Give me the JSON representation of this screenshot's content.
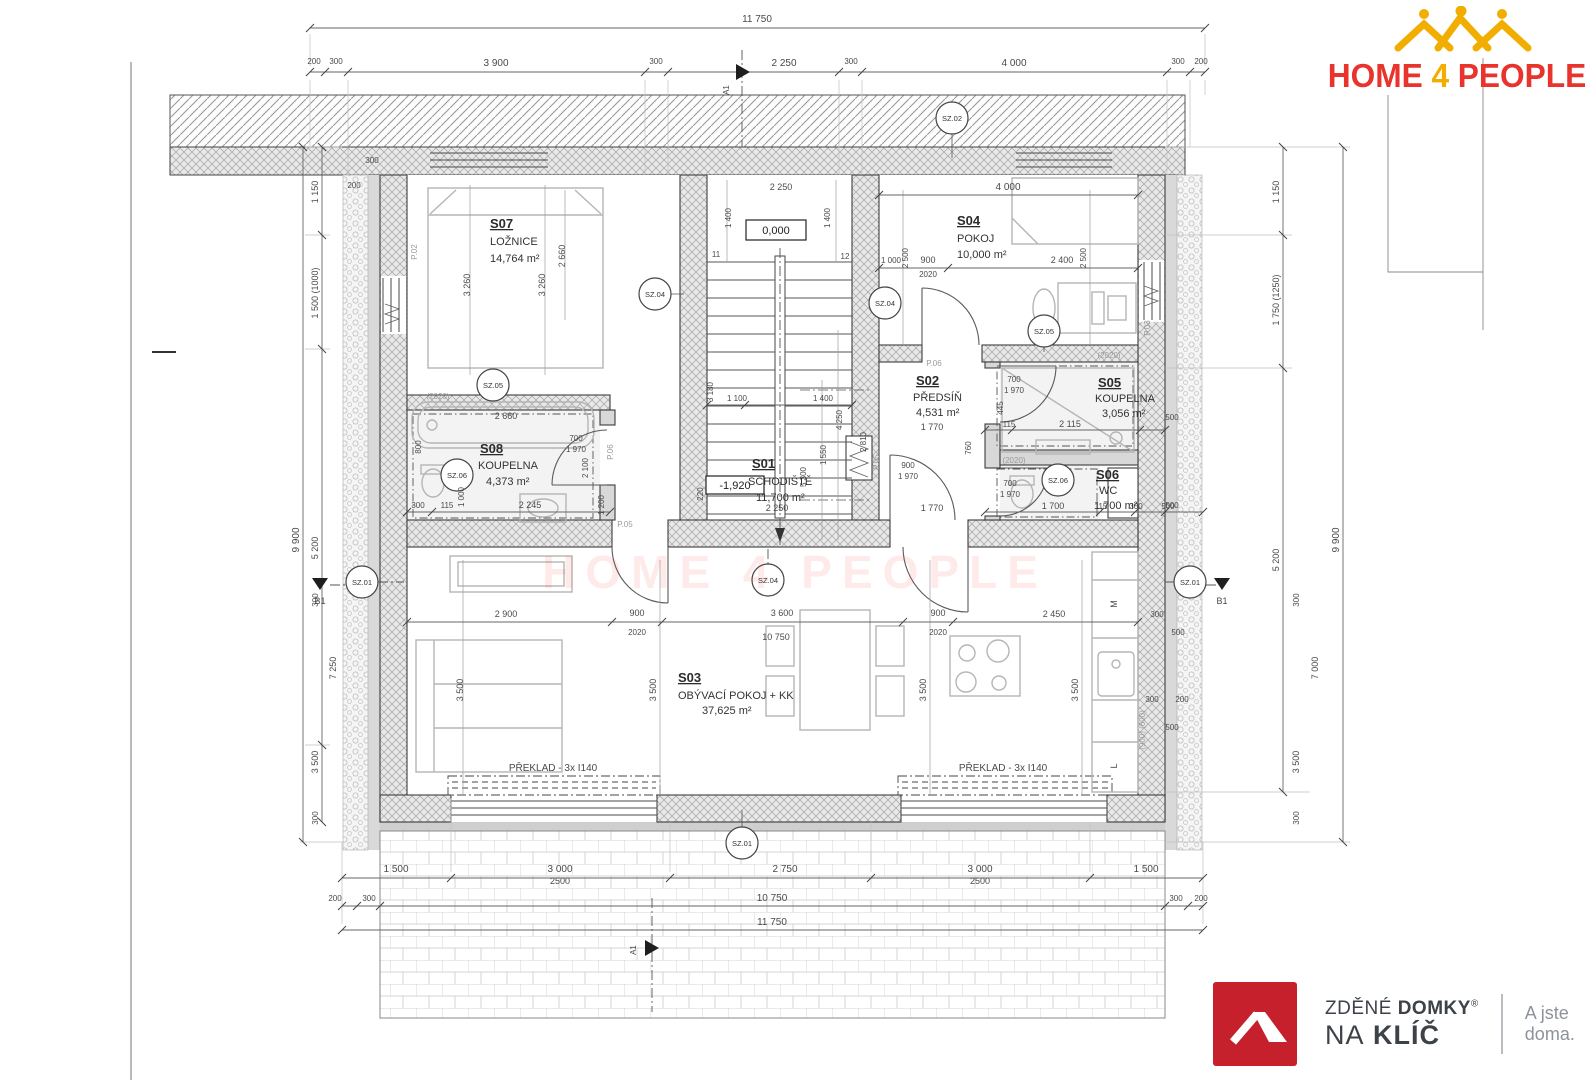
{
  "logo": {
    "home": "HOME",
    "four": "4",
    "people": "PEOPLE"
  },
  "brand": {
    "l1_normal": "ZDĚNÉ",
    "l1_bold": "DOMKY",
    "reg": "®",
    "l2_normal": "NA",
    "l2_bold": "KLÍČ",
    "tagline": "A jste doma."
  },
  "watermark": "HOME 4 PEOPLE",
  "levels": {
    "zero": "0,000",
    "minus": "-1,920"
  },
  "lintel": "PŘEKLAD - 3x I140",
  "rooms": {
    "s01": {
      "id": "S01",
      "name": "SCHODIŠTĚ",
      "area": "11,700 m²"
    },
    "s02": {
      "id": "S02",
      "name": "PŘEDSÍŇ",
      "area": "4,531 m²"
    },
    "s03": {
      "id": "S03",
      "name": "OBÝVACÍ POKOJ + KK",
      "area": "37,625 m²"
    },
    "s04": {
      "id": "S04",
      "name": "POKOJ",
      "area": "10,000 m²"
    },
    "s05": {
      "id": "S05",
      "name": "KOUPELNA",
      "area": "3,056 m²"
    },
    "s06": {
      "id": "S06",
      "name": "WC",
      "area": "1,700 m²"
    },
    "s07": {
      "id": "S07",
      "name": "LOŽNICE",
      "area": "14,764 m²"
    },
    "s08": {
      "id": "S08",
      "name": "KOUPELNA",
      "area": "4,373 m²"
    }
  },
  "markers": {
    "a1": "A1",
    "b1": "B1",
    "sz01": "SZ.01",
    "sz02": "SZ.02",
    "sz04": "SZ.04",
    "sz05": "SZ.05",
    "sz06": "SZ.06",
    "p02": "P.02",
    "p03": "P.03",
    "p05": "P.05",
    "p06": "P.06",
    "m": "M",
    "l": "L",
    "n11": "11",
    "n12": "12"
  },
  "dims": {
    "top_total": "11 750",
    "top": [
      "200",
      "300",
      "3 900",
      "300",
      "2 250",
      "300",
      "4 000",
      "300",
      "200"
    ],
    "bottom1": [
      "1 500",
      "3 000",
      "2500",
      "2 750",
      "3 000",
      "2500",
      "1 500"
    ],
    "bottom2": [
      "200",
      "300",
      "10 750",
      "300",
      "200"
    ],
    "bottom_total": "11 750",
    "left": [
      "1 150",
      "1 500 (1000)",
      "5 200",
      "9 900",
      "300",
      "7 250",
      "3 500",
      "300",
      "200",
      "300"
    ],
    "right": [
      "1 150",
      "1 750 (1250)",
      "5 200",
      "9 900",
      "300",
      "7 000",
      "3 500",
      "300",
      "500",
      "500",
      "300",
      "200",
      "500"
    ],
    "s07": [
      "3 260",
      "3 260",
      "2 660"
    ],
    "s04": [
      "4 000",
      "1 000",
      "900",
      "2020",
      "2 400",
      "2 500",
      "2 500"
    ],
    "stair": [
      "2 250",
      "1 400",
      "1 400",
      "1 100",
      "1 400",
      "3 180",
      "4 250",
      "1 550",
      "5 300",
      "2 810",
      "2 250",
      "220"
    ],
    "s08": [
      "(2020)",
      "2 660",
      "800",
      "1 000",
      "115",
      "2 245",
      "300",
      "2 100",
      "1 200",
      "700",
      "1 970"
    ],
    "s02": [
      "1 770",
      "1 770",
      "900",
      "1 970",
      "760"
    ],
    "s05": [
      "(2020)",
      "445",
      "2 115",
      "115",
      "700",
      "1 970"
    ],
    "s06": [
      "(2020)",
      "700",
      "1 970",
      "1 700",
      "115",
      "300",
      "500"
    ],
    "s03": [
      "2 900",
      "900",
      "2020",
      "3 600",
      "10 750",
      "900",
      "2020",
      "2 450",
      "3 500",
      "3 500",
      "3 500",
      "3 500",
      "300",
      "500"
    ],
    "kitchen": [
      "(900) (600)"
    ]
  }
}
